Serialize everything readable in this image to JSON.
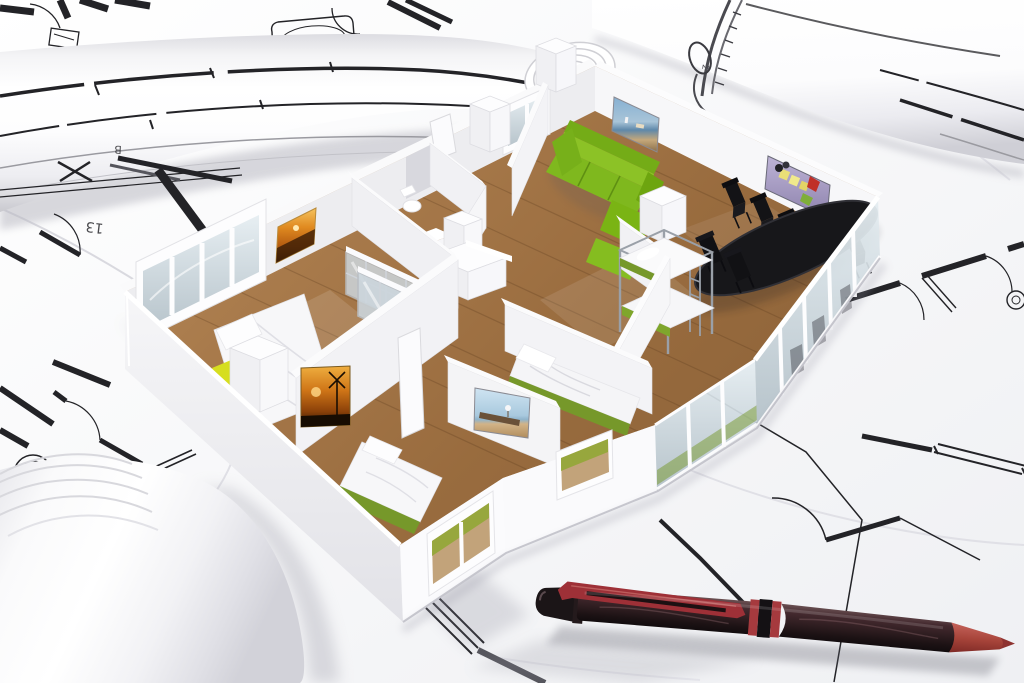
{
  "scene": {
    "type": "3d-architecture-render",
    "description": "White 3D apartment floor-plan model standing on flat and rolled architectural blueprints, dark red ballpoint pen in the foreground",
    "labels": {
      "sheet_13": "13",
      "sheet_b": "B",
      "roll_mark": "2"
    }
  },
  "colors": {
    "paper": "#fcfcfd",
    "paper_shade": "#e9e9ee",
    "ink": "#232327",
    "ink_soft": "#8a8a90",
    "wall": "#f5f5f7",
    "wall_shade": "#e6e6ea",
    "floor_wood": "#a87a4b",
    "floor_wood_dark": "#8a6036",
    "sofa_green": "#7fb81e",
    "bed_green": "#76982a",
    "accent_yellow": "#d6de1f",
    "dining_black": "#17171a",
    "metal": "#9aa0a8",
    "glass": "#ccd7de",
    "pen_body": "#37262a",
    "pen_red": "#9e3037",
    "pen_tip": "#a7443a",
    "painting_sunset": "#e08a20",
    "painting_sky": "#7ba7c9",
    "painting_food": "#9c92ba",
    "painting_beach": "#bcd7e8"
  },
  "objects": {
    "rolls": [
      "blueprint-roll-top-left",
      "blueprint-roll-top-right",
      "blueprint-roll-bottom-left"
    ],
    "rooms": [
      "living-room",
      "dining-area",
      "kitchen",
      "bathroom",
      "master-bedroom",
      "bedroom-2",
      "bedroom-3",
      "kids-room"
    ],
    "furniture": [
      "green-sofa",
      "dining-table",
      "dining-chairs",
      "double-bed",
      "single-bed",
      "bunk-bed",
      "wardrobe",
      "toilet",
      "kitchen-counter"
    ],
    "paintings": [
      "sunset-painting",
      "harbor-painting",
      "food-still-life",
      "windmill-painting",
      "beach-painting"
    ],
    "tools": [
      "ballpoint-pen"
    ]
  }
}
